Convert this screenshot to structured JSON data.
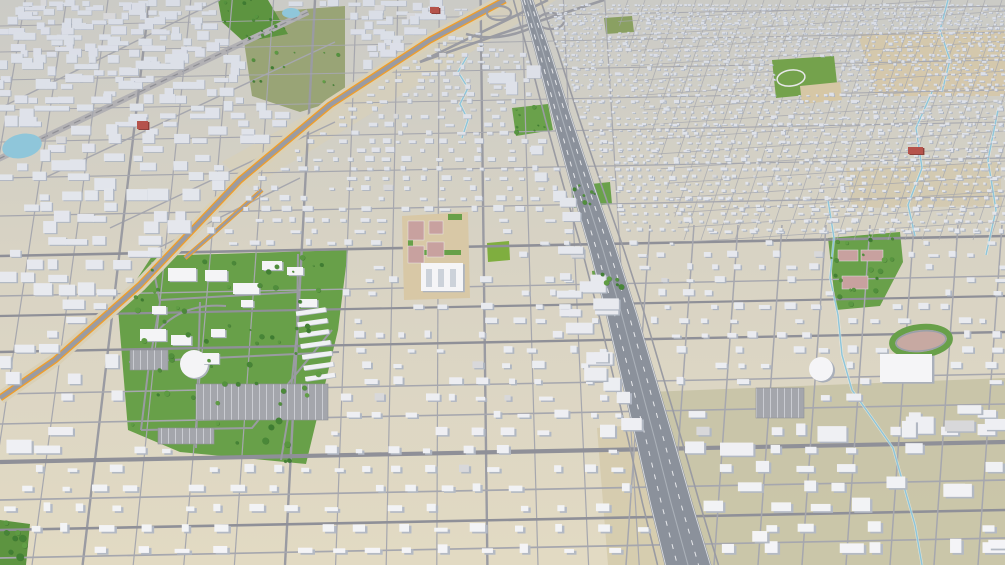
{
  "meta": {
    "title": "3d-city-aerial-model",
    "width": 1005,
    "height": 565
  },
  "colors": {
    "ground_far": "#cbcbc6",
    "ground_near": "#e2dac3",
    "road_minor": "#a6a7ae",
    "road_major": "#8f9098",
    "road_collector": "#9a9ba2",
    "freeway_fill": "#8b919b",
    "freeway_edge": "#d8dbe0",
    "freeway_dash": "#f2f3f5",
    "orange_line": "#ef9e2c",
    "orange_verge": "#d9d0b6",
    "rail_band": "#b2b1b4",
    "rail_line": "#8e8e94",
    "park_green": "#68a049",
    "park_bright": "#7fae3f",
    "field_olive": "#99a476",
    "tree_dark": "#3c7a31",
    "tree_light": "#63a046",
    "water": "#8fc6da",
    "building_top_near": "#f5f5f7",
    "building_top_far": "#d9dde6",
    "building_side_near": "#b4bac4",
    "building_side_far": "#a9b1bf",
    "red_building": "#b5534c",
    "red_building_side": "#8c3e39",
    "court_pink": "#c8a19f",
    "dirt_tan": "#d6c7a5",
    "khaki_se": "#c6c2a4",
    "parking_fill": "#a4a6ac",
    "parking_stripe": "#cfd1d6"
  },
  "scene": {
    "terrain_patches": [
      {
        "name": "khaki-southeast",
        "points": [
          [
            648,
            392
          ],
          [
            1005,
            378
          ],
          [
            1005,
            565
          ],
          [
            678,
            565
          ]
        ],
        "fill": "#c6c2a4",
        "op": 0.85
      },
      {
        "name": "tan-strip-freeway-west",
        "points": [
          [
            597,
            428
          ],
          [
            648,
            424
          ],
          [
            676,
            565
          ],
          [
            608,
            565
          ]
        ],
        "fill": "#d5cbad",
        "op": 0.9
      },
      {
        "name": "tan-northeast-1",
        "points": [
          [
            858,
            34
          ],
          [
            1005,
            30
          ],
          [
            1005,
            96
          ],
          [
            876,
            96
          ]
        ],
        "fill": "#d6c7a5",
        "op": 0.8
      },
      {
        "name": "tan-northeast-2",
        "points": [
          [
            846,
            168
          ],
          [
            1000,
            162
          ],
          [
            1002,
            206
          ],
          [
            852,
            208
          ]
        ],
        "fill": "#d3c6a8",
        "op": 0.65
      },
      {
        "name": "tan-highway-corridor",
        "points": [
          [
            512,
            0
          ],
          [
            556,
            0
          ],
          [
            250,
            188
          ],
          [
            222,
            162
          ]
        ],
        "fill": "#d9d0b8",
        "op": 0.6
      }
    ],
    "parks": [
      {
        "name": "fairground-campus-park",
        "points": [
          [
            118,
            308
          ],
          [
            152,
            256
          ],
          [
            348,
            250
          ],
          [
            338,
            330
          ],
          [
            306,
            464
          ],
          [
            180,
            452
          ],
          [
            128,
            430
          ]
        ],
        "fill": "#68a049",
        "trees": 62
      },
      {
        "name": "olive-field-northwest",
        "points": [
          [
            240,
            14
          ],
          [
            345,
            6
          ],
          [
            345,
            98
          ],
          [
            300,
            112
          ],
          [
            252,
            96
          ]
        ],
        "fill": "#99a476",
        "trees": 12
      },
      {
        "name": "tree-cluster-north",
        "points": [
          [
            218,
            0
          ],
          [
            268,
            0
          ],
          [
            288,
            34
          ],
          [
            244,
            42
          ],
          [
            222,
            22
          ]
        ],
        "fill": "#5d9440",
        "trees": 14
      },
      {
        "name": "courts-park-east",
        "points": [
          [
            828,
            238
          ],
          [
            900,
            232
          ],
          [
            903,
            262
          ],
          [
            880,
            306
          ],
          [
            836,
            310
          ]
        ],
        "fill": "#69a04a",
        "trees": 20
      },
      {
        "name": "square-park-center",
        "points": [
          [
            487,
            243
          ],
          [
            509,
            241
          ],
          [
            510,
            260
          ],
          [
            488,
            262
          ]
        ],
        "fill": "#7fae3f",
        "trees": 0
      },
      {
        "name": "park-center-north",
        "points": [
          [
            512,
            108
          ],
          [
            548,
            104
          ],
          [
            553,
            130
          ],
          [
            516,
            136
          ]
        ],
        "fill": "#6aa14b",
        "trees": 9
      },
      {
        "name": "park-center-1",
        "points": [
          [
            572,
            186
          ],
          [
            610,
            182
          ],
          [
            612,
            204
          ],
          [
            574,
            208
          ]
        ],
        "fill": "#6aa14b",
        "trees": 7
      },
      {
        "name": "park-center-2",
        "points": [
          [
            592,
            271
          ],
          [
            622,
            267
          ],
          [
            624,
            290
          ],
          [
            594,
            293
          ]
        ],
        "fill": "#6aa14b",
        "trees": 6
      },
      {
        "name": "park-bottom-left",
        "points": [
          [
            0,
            520
          ],
          [
            30,
            524
          ],
          [
            26,
            565
          ],
          [
            0,
            565
          ]
        ],
        "fill": "#5d9440",
        "trees": 8
      },
      {
        "name": "green-top-center",
        "points": [
          [
            604,
            18
          ],
          [
            632,
            16
          ],
          [
            634,
            32
          ],
          [
            606,
            34
          ]
        ],
        "fill": "#8aa062",
        "trees": 0
      }
    ],
    "east_courts": [
      [
        838,
        250,
        20,
        11
      ],
      [
        861,
        250,
        22,
        11
      ],
      [
        842,
        276,
        26,
        13
      ]
    ],
    "rail": {
      "band": [
        [
          308,
          12
        ],
        [
          -12,
          164
        ]
      ],
      "parallels": [
        [
          [
            220,
            0
          ],
          [
            0,
            108
          ]
        ],
        [
          [
            335,
            42
          ],
          [
            40,
            180
          ]
        ],
        [
          [
            335,
            122
          ],
          [
            110,
            228
          ]
        ],
        [
          [
            300,
            178
          ],
          [
            150,
            252
          ]
        ]
      ]
    },
    "orange_highway": {
      "main": [
        [
          505,
          0
        ],
        [
          430,
          40
        ],
        [
          330,
          105
        ],
        [
          240,
          180
        ],
        [
          140,
          285
        ],
        [
          55,
          360
        ],
        [
          0,
          398
        ]
      ],
      "spur": [
        [
          262,
          190
        ],
        [
          215,
          232
        ],
        [
          185,
          258
        ]
      ]
    },
    "freeway": {
      "centerline": [
        [
          527,
          0
        ],
        [
          543,
          52
        ],
        [
          562,
          118
        ],
        [
          582,
          184
        ],
        [
          603,
          250
        ],
        [
          621,
          312
        ],
        [
          638,
          376
        ],
        [
          655,
          440
        ],
        [
          671,
          503
        ],
        [
          688,
          565
        ]
      ],
      "w_base": 6.5,
      "w_grow": 0.03
    },
    "interchange": {
      "loops": [
        [
          499,
          13,
          12,
          7
        ],
        [
          551,
          21,
          13,
          8
        ]
      ],
      "ramps": [
        "M420,62 L548,0",
        "M604,0 L500,34 L420,62",
        "M466,34 Q500,44 540,24"
      ]
    },
    "streets": {
      "vp_x": 450,
      "top_k": 0.9,
      "bot_k": 1.1,
      "xm0": -160,
      "xm1": 640,
      "step": 46,
      "major_every": 4,
      "horizontals": [
        {
          "y": 26,
          "w": 0.9
        },
        {
          "y": 52,
          "w": 0.9
        },
        {
          "y": 80,
          "w": 1.0
        },
        {
          "y": 110,
          "w": 1.0
        },
        {
          "y": 142,
          "w": 1.1
        },
        {
          "y": 178,
          "w": 1.2
        },
        {
          "y": 216,
          "w": 1.3
        },
        {
          "y": 256,
          "w": 2.6
        },
        {
          "y": 296,
          "w": 1.4
        },
        {
          "y": 316,
          "w": 2.2
        },
        {
          "y": 352,
          "w": 2.4
        },
        {
          "y": 394,
          "w": 1.5
        },
        {
          "y": 424,
          "w": 1.6
        },
        {
          "y": 462,
          "w": 4.2
        },
        {
          "y": 500,
          "w": 1.7
        },
        {
          "y": 530,
          "w": 2.6
        },
        {
          "y": 558,
          "w": 1.7
        }
      ],
      "tilt": 20,
      "east_vx0": 630,
      "east_vx1": 1080,
      "east_step": 44,
      "east_lean": 20,
      "east_ytop": 225
    },
    "ne_grid": {
      "clip": [
        [
          612,
          0
        ],
        [
          1005,
          0
        ],
        [
          1005,
          242
        ],
        [
          682,
          242
        ]
      ],
      "vx0": 628,
      "vx1": 1170,
      "vstep": 17,
      "vshift": -80,
      "vy1": 240,
      "hy0": 10,
      "hy1": 240,
      "hstep": 15,
      "hshift": -26
    },
    "campus": {
      "roads": [
        "M152,262 L160,302 L148,372 L141,430",
        "M298,254 L297,332 L288,418 L281,460",
        "M129,362 L339,352",
        "M141,430 L252,428 L332,330",
        "M200,302 L196,448",
        "M150,341 Q176,302 226,306",
        "M160,300 L298,292"
      ],
      "parking": [
        [
          196,
          384,
          132,
          36
        ],
        [
          130,
          350,
          38,
          20
        ],
        [
          158,
          428,
          56,
          16
        ]
      ],
      "buildings": [
        [
          168,
          268,
          28,
          13
        ],
        [
          205,
          270,
          22,
          11
        ],
        [
          233,
          283,
          26,
          11
        ],
        [
          262,
          261,
          20,
          9
        ],
        [
          287,
          267,
          16,
          8
        ],
        [
          299,
          299,
          18,
          8
        ],
        [
          140,
          329,
          26,
          12
        ],
        [
          171,
          335,
          20,
          10
        ],
        [
          211,
          329,
          14,
          8
        ],
        [
          241,
          300,
          12,
          7
        ],
        [
          152,
          306,
          14,
          8
        ]
      ],
      "greenhouses": {
        "x": 301,
        "y0": 309,
        "dy": 11,
        "n": 7,
        "w": 30,
        "h": 4.5,
        "rot": -8,
        "cx": 316,
        "cy": 348
      },
      "fan": {
        "cx": 194,
        "cy": 364,
        "r": 14,
        "tab": [
          203,
          353,
          16,
          11
        ]
      }
    },
    "school_center": {
      "poly": [
        [
          402,
          216
        ],
        [
          468,
          212
        ],
        [
          470,
          298
        ],
        [
          404,
          300
        ]
      ],
      "fill": "#d8c8a6",
      "courts": [
        [
          408,
          221,
          16,
          19
        ],
        [
          408,
          246,
          16,
          17
        ],
        [
          429,
          221,
          14,
          13
        ],
        [
          427,
          242,
          17,
          15
        ]
      ],
      "greens": [
        [
          417,
          250,
          44,
          5
        ],
        [
          408,
          222,
          5,
          36
        ],
        [
          448,
          214,
          14,
          6
        ]
      ],
      "building": [
        421,
        263,
        42,
        28
      ]
    },
    "school_ne": {
      "poly": [
        [
          772,
          60
        ],
        [
          834,
          56
        ],
        [
          838,
          92
        ],
        [
          776,
          98
        ]
      ],
      "fill": "#74a24c",
      "track": {
        "cx": 791,
        "cy": 78,
        "rx": 14,
        "ry": 8,
        "rot": -8
      },
      "dirt": [
        [
          800,
          86
        ],
        [
          840,
          82
        ],
        [
          842,
          100
        ],
        [
          802,
          104
        ]
      ]
    },
    "fairgrounds_se": {
      "oval": {
        "cx": 921,
        "cy": 341,
        "rx": 29,
        "ry": 14,
        "rot": -6
      },
      "arena": [
        880,
        354,
        52,
        28
      ],
      "dome": {
        "cx": 821,
        "cy": 369,
        "r": 12
      },
      "parking": [
        756,
        388,
        48,
        30
      ]
    },
    "water": {
      "ponds": [
        {
          "cx": 22,
          "cy": 146,
          "rx": 20,
          "ry": 12,
          "rot": -12
        },
        {
          "cx": 291,
          "cy": 13,
          "rx": 9,
          "ry": 5,
          "rot": 0
        }
      ],
      "streams": [
        [
          [
            468,
            55
          ],
          [
            458,
            72
          ],
          [
            468,
            88
          ],
          [
            460,
            104
          ],
          [
            468,
            120
          ],
          [
            462,
            138
          ]
        ],
        [
          [
            828,
            200
          ],
          [
            834,
            238
          ],
          [
            830,
            278
          ],
          [
            838,
            315
          ],
          [
            842,
            355
          ],
          [
            852,
            390
          ],
          [
            872,
            418
          ],
          [
            893,
            448
          ],
          [
            905,
            490
          ],
          [
            915,
            525
          ],
          [
            922,
            565
          ]
        ],
        [
          [
            932,
            92
          ],
          [
            916,
            128
          ],
          [
            922,
            168
          ],
          [
            908,
            205
          ],
          [
            915,
            236
          ]
        ],
        [
          [
            998,
            110
          ],
          [
            988,
            160
          ],
          [
            996,
            210
          ],
          [
            986,
            255
          ]
        ],
        [
          [
            948,
            0
          ],
          [
            940,
            30
          ],
          [
            950,
            60
          ],
          [
            942,
            92
          ]
        ]
      ]
    },
    "red_buildings": [
      [
        137,
        121,
        11,
        8
      ],
      [
        430,
        7,
        9,
        6
      ],
      [
        908,
        147,
        15,
        7
      ]
    ],
    "buildings": {
      "seed": 20240913,
      "row_base": 4.2,
      "row_grow": 0.032,
      "col_base": 8,
      "col_grow": 0.055,
      "districts": {
        "ne": {
          "keep": 0.55,
          "mult": 0.8
        },
        "ne_fine": {
          "keep": 0.85,
          "mult": 0.62
        },
        "se": {
          "keep": 0.5,
          "mult": 1.6
        },
        "nw_industrial": {
          "keep": 0.42,
          "mult": 2.3
        },
        "left_mid": {
          "keep": 0.5,
          "mult": 2.0
        },
        "bottom": {
          "keep": 0.78,
          "mult": 1.05
        },
        "center": {
          "keep": 0.66,
          "mult": 1.05
        }
      },
      "commercial_west_count": 30,
      "industrial_se_count": 14
    }
  }
}
